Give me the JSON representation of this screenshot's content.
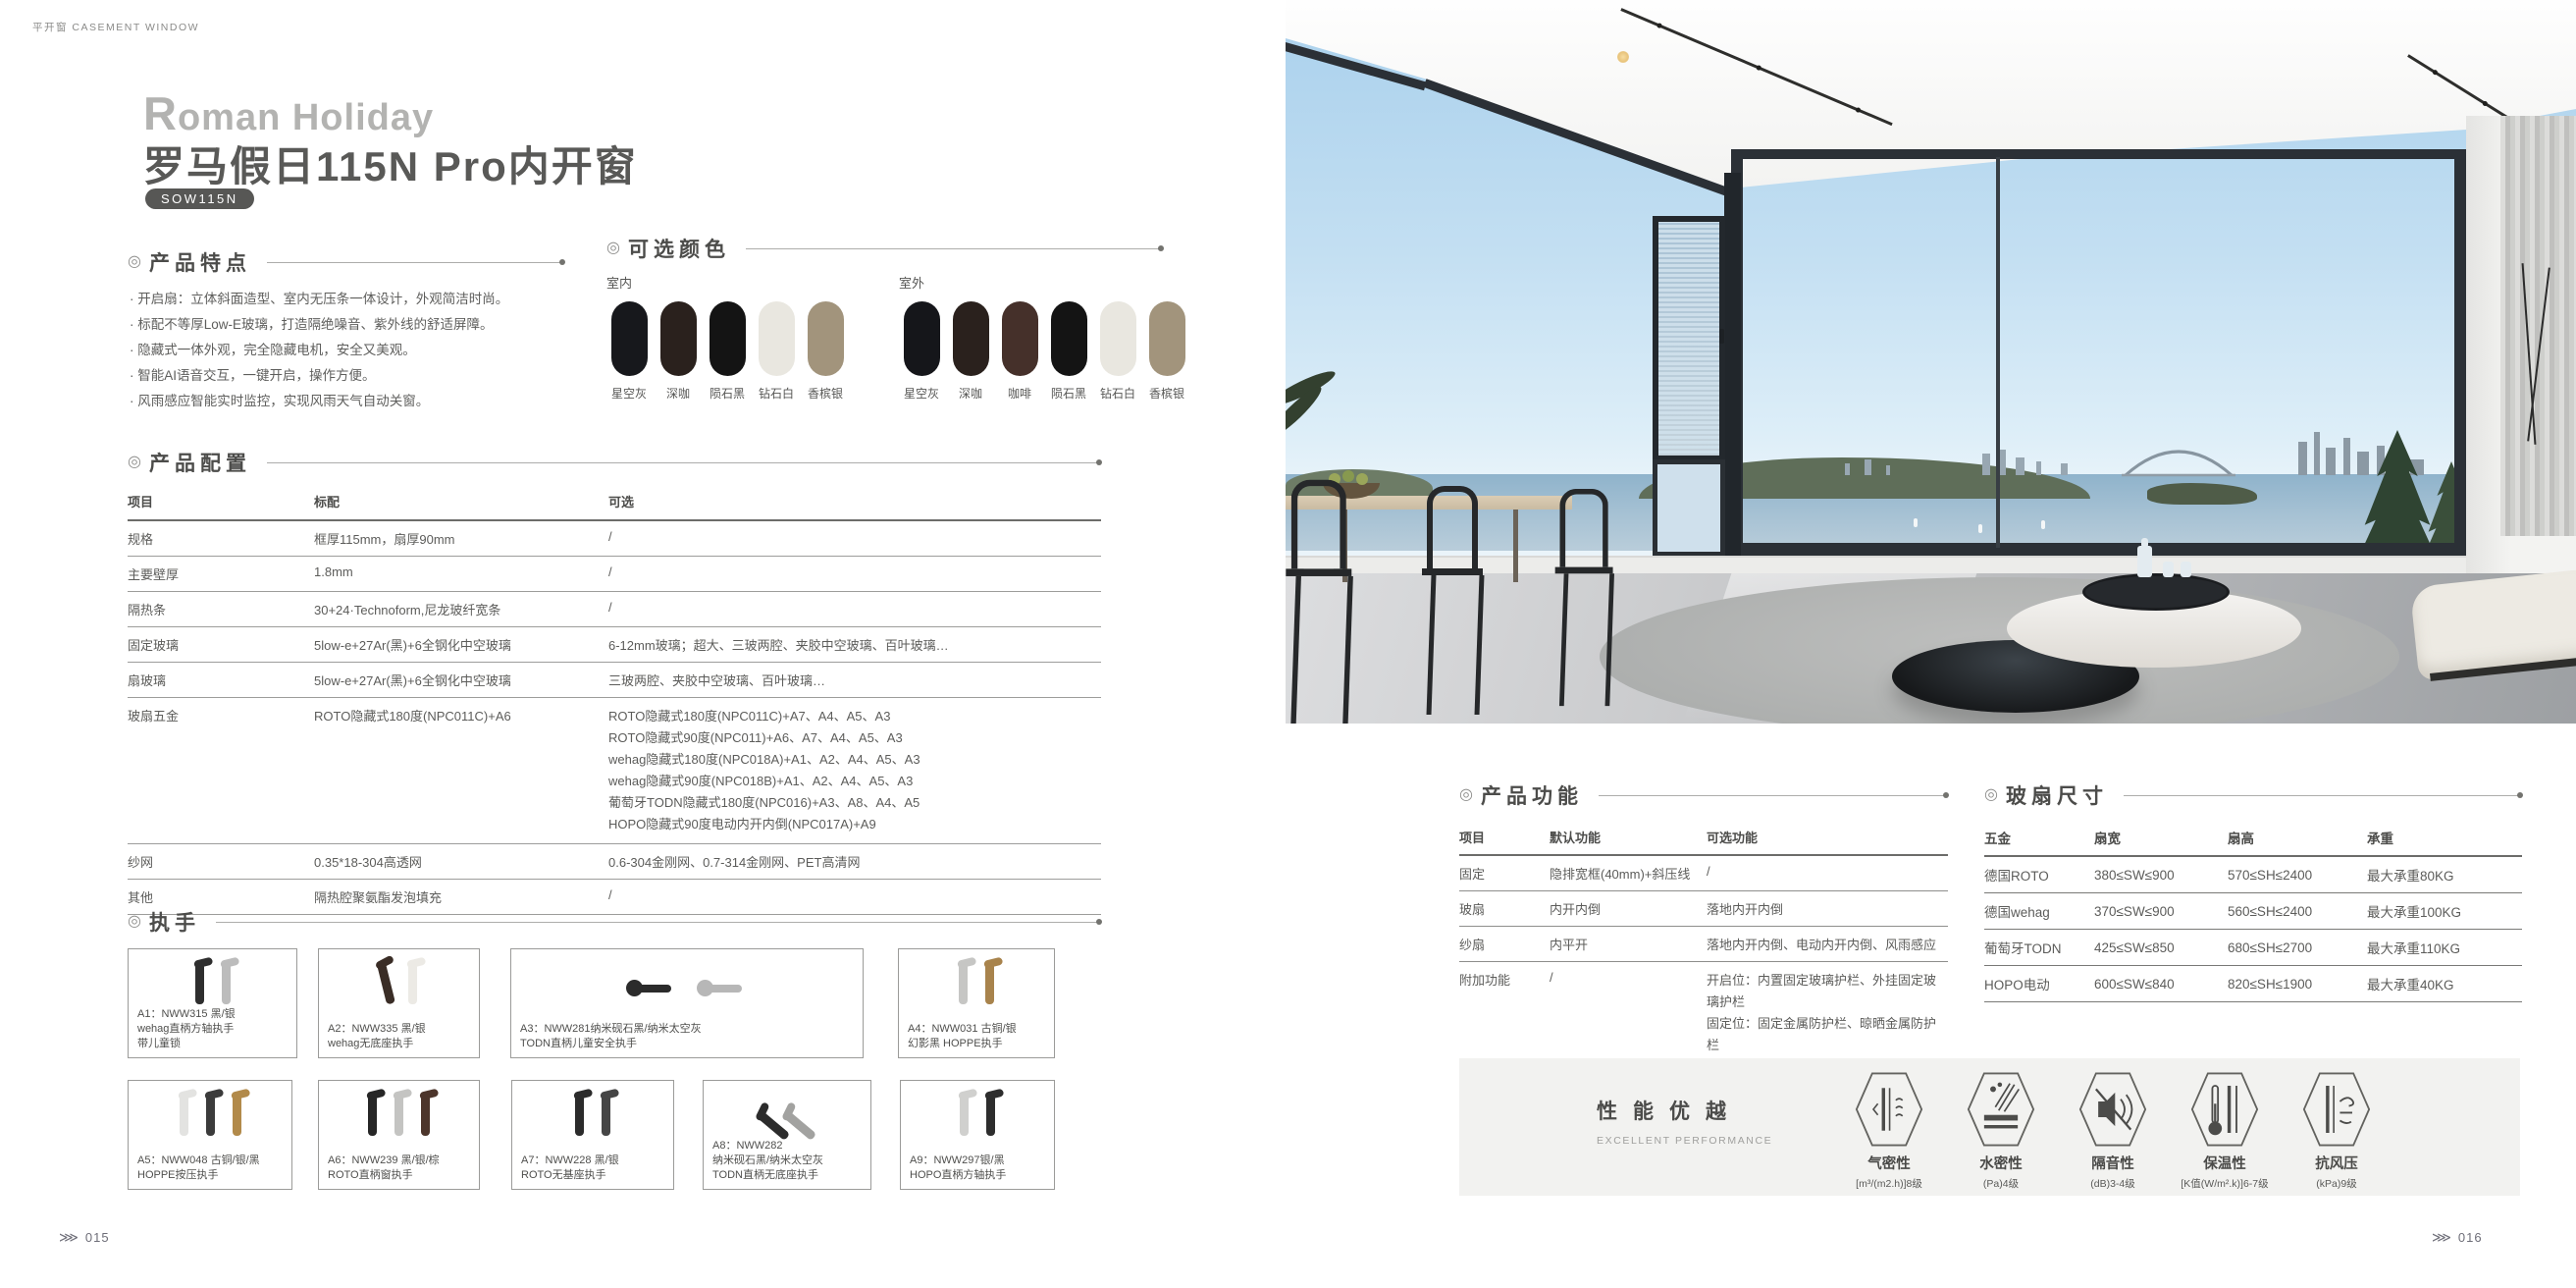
{
  "header": {
    "category": "平开窗 CASEMENT WINDOW"
  },
  "brand": {
    "en": "Roman Holiday",
    "zh": "罗马假日115N Pro内开窗",
    "model": "SOW115N"
  },
  "features": {
    "heading": "产品特点",
    "items": [
      "开启扇：立体斜面造型、室内无压条一体设计，外观简洁时尚。",
      "标配不等厚Low-E玻璃，打造隔绝噪音、紫外线的舒适屏障。",
      "隐藏式一体外观，完全隐藏电机，安全又美观。",
      "智能AI语音交互，一键开启，操作方便。",
      "风雨感应智能实时监控，实现风雨天气自动关窗。"
    ]
  },
  "colors": {
    "heading": "可选颜色",
    "indoor_label": "室内",
    "outdoor_label": "室外",
    "indoor": [
      {
        "name": "星空灰",
        "hex": "#17181c"
      },
      {
        "name": "深咖",
        "hex": "#2a211d"
      },
      {
        "name": "陨石黑",
        "hex": "#141414"
      },
      {
        "name": "钻石白",
        "hex": "#e9e7e0"
      },
      {
        "name": "香槟银",
        "hex": "#a2947c"
      }
    ],
    "outdoor": [
      {
        "name": "星空灰",
        "hex": "#15161a"
      },
      {
        "name": "深咖",
        "hex": "#2a211d"
      },
      {
        "name": "咖啡",
        "hex": "#45302a"
      },
      {
        "name": "陨石黑",
        "hex": "#141414"
      },
      {
        "name": "钻石白",
        "hex": "#e9e7e0"
      },
      {
        "name": "香槟银",
        "hex": "#a2947c"
      }
    ]
  },
  "config": {
    "heading": "产品配置",
    "headers": [
      "项目",
      "标配",
      "可选"
    ],
    "rows": [
      {
        "item": "规格",
        "standard": "框厚115mm，扇厚90mm",
        "optional": "/"
      },
      {
        "item": "主要壁厚",
        "standard": "1.8mm",
        "optional": "/"
      },
      {
        "item": "隔热条",
        "standard": "30+24·Technoform,尼龙玻纤宽条",
        "optional": "/"
      },
      {
        "item": "固定玻璃",
        "standard": "5low-e+27Ar(黑)+6全钢化中空玻璃",
        "optional": "6-12mm玻璃；超大、三玻两腔、夹胶中空玻璃、百叶玻璃…"
      },
      {
        "item": "扇玻璃",
        "standard": "5low-e+27Ar(黑)+6全钢化中空玻璃",
        "optional": "三玻两腔、夹胶中空玻璃、百叶玻璃…"
      },
      {
        "item": "玻扇五金",
        "standard": "ROTO隐藏式180度(NPC011C)+A6",
        "optional_lines": [
          "ROTO隐藏式180度(NPC011C)+A7、A4、A5、A3",
          "ROTO隐藏式90度(NPC011)+A6、A7、A4、A5、A3",
          "wehag隐藏式180度(NPC018A)+A1、A2、A4、A5、A3",
          "wehag隐藏式90度(NPC018B)+A1、A2、A4、A5、A3",
          "葡萄牙TODN隐藏式180度(NPC016)+A3、A8、A4、A5",
          "HOPO隐藏式90度电动内开内倒(NPC017A)+A9"
        ]
      },
      {
        "item": "纱网",
        "standard": "0.35*18-304高透网",
        "optional": "0.6-304金刚网、0.7-314金刚网、PET高清网"
      },
      {
        "item": "其他",
        "standard": "隔热腔聚氨酯发泡填充",
        "optional": "/"
      }
    ]
  },
  "handles": {
    "heading": "执手",
    "items": [
      {
        "lines": [
          "A1：NWW315 黑/银",
          "wehag直柄方轴执手",
          "带儿童锁"
        ],
        "colors": [
          "#2e2e2e",
          "#bcbcbc"
        ]
      },
      {
        "lines": [
          "A2：NWW335 黑/银",
          "wehag无底座执手",
          ""
        ],
        "colors": [
          "#3a2d26",
          "#eceae5"
        ]
      },
      {
        "lines": [
          "A3：NWW281纳米砚石黑/纳米太空灰",
          "TODN直柄儿童安全执手",
          ""
        ],
        "colors": [
          "#2b2b2b",
          "#b7b7b7"
        ]
      },
      {
        "lines": [
          "A4：NWW031 古铜/银",
          "幻影黑 HOPPE执手",
          ""
        ],
        "colors": [
          "#c6c6c4",
          "#a8834c"
        ]
      },
      {
        "lines": [
          "A5：NWW048 古铜/银/黑",
          "HOPPE按压执手",
          ""
        ],
        "colors": [
          "#e3e3e1",
          "#3b3b3b",
          "#b28a4a"
        ]
      },
      {
        "lines": [
          "A6：NWW239 黑/银/棕",
          "ROTO直柄窗执手",
          ""
        ],
        "colors": [
          "#262626",
          "#c4c4c2",
          "#4c352b"
        ]
      },
      {
        "lines": [
          "A7：NWW228 黑/银",
          "ROTO无基座执手",
          ""
        ],
        "colors": [
          "#2b2b2b",
          "#454545"
        ]
      },
      {
        "lines": [
          "A8：NWW282",
          "纳米砚石黑/纳米太空灰",
          "TODN直柄无底座执手"
        ],
        "colors": [
          "#2c2c2c",
          "#a2a2a0"
        ]
      },
      {
        "lines": [
          "A9：NWW297银/黑",
          "HOPO直柄方轴执手",
          ""
        ],
        "colors": [
          "#d0d0ce",
          "#2d2d2d"
        ]
      }
    ]
  },
  "functions": {
    "heading": "产品功能",
    "headers": [
      "项目",
      "默认功能",
      "可选功能"
    ],
    "rows": [
      {
        "item": "固定",
        "default_fn": "隐排宽框(40mm)+斜压线",
        "optional_fn": "/"
      },
      {
        "item": "玻扇",
        "default_fn": "内开内倒",
        "optional_fn": "落地内开内倒"
      },
      {
        "item": "纱扇",
        "default_fn": "内平开",
        "optional_fn": "落地内开内倒、电动内开内倒、风雨感应"
      },
      {
        "item": "附加功能",
        "default_fn": "/",
        "optional_lines": [
          "开启位：内置固定玻璃护栏、外挂固定玻璃护栏",
          "固定位：固定金属防护栏、晾晒金属防护栏"
        ]
      },
      {
        "item": "工艺",
        "default_fn": "常规",
        "optional_fn": "异形"
      }
    ]
  },
  "sizes": {
    "heading": "玻扇尺寸",
    "headers": [
      "五金",
      "扇宽",
      "扇高",
      "承重"
    ],
    "rows": [
      {
        "hardware": "德国ROTO",
        "width": "380≤SW≤900",
        "height": "570≤SH≤2400",
        "load": "最大承重80KG"
      },
      {
        "hardware": "德国wehag",
        "width": "370≤SW≤900",
        "height": "560≤SH≤2400",
        "load": "最大承重100KG"
      },
      {
        "hardware": "葡萄牙TODN",
        "width": "425≤SW≤850",
        "height": "680≤SH≤2700",
        "load": "最大承重110KG"
      },
      {
        "hardware": "HOPO电动",
        "width": "600≤SW≤840",
        "height": "820≤SH≤1900",
        "load": "最大承重40KG"
      }
    ]
  },
  "performance": {
    "title": "性能优越",
    "subtitle": "EXCELLENT PERFORMANCE",
    "items": [
      {
        "name": "气密性",
        "rating": "[m³/(m2.h)]8级",
        "icon": "air-tightness-icon"
      },
      {
        "name": "水密性",
        "rating": "(Pa)4级",
        "icon": "water-tightness-icon"
      },
      {
        "name": "隔音性",
        "rating": "(dB)3-4级",
        "icon": "sound-insulation-icon"
      },
      {
        "name": "保温性",
        "rating": "[K值(W/m².k)]6-7级",
        "icon": "thermal-insulation-icon"
      },
      {
        "name": "抗风压",
        "rating": "(kPa)9级",
        "icon": "wind-pressure-icon"
      }
    ]
  },
  "pagination": {
    "marker": "⋙",
    "left": "015",
    "right": "016"
  }
}
